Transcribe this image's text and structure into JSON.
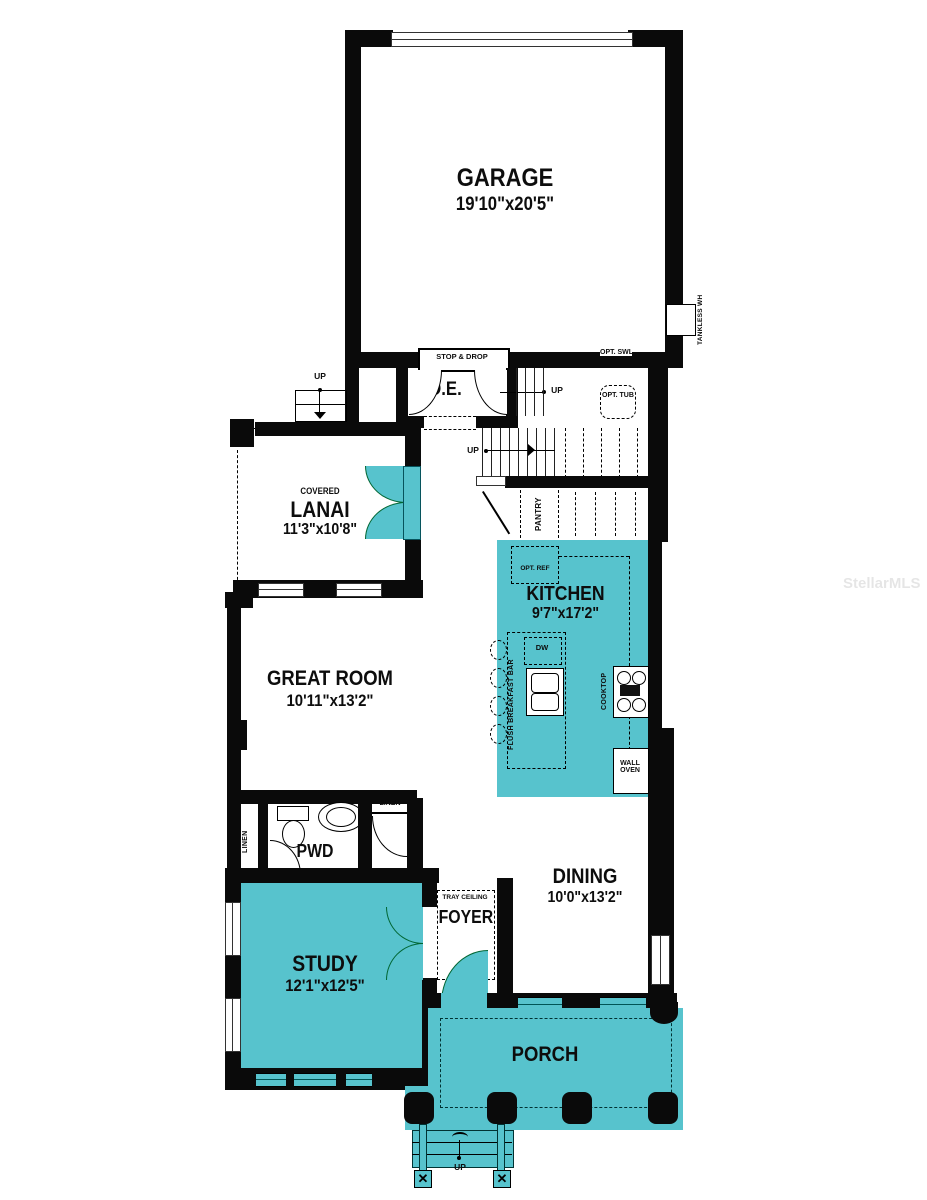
{
  "watermark": "StellarMLS",
  "colors": {
    "accent_teal": "#57c3cd",
    "wall": "#0a0a0a"
  },
  "rooms": {
    "garage": {
      "name": "GARAGE",
      "dims": "19'10\"x20'5\""
    },
    "oe": {
      "name": "O.E."
    },
    "lanai": {
      "prefix": "COVERED",
      "name": "LANAI",
      "dims": "11'3\"x10'8\""
    },
    "great_room": {
      "name": "GREAT ROOM",
      "dims": "10'11\"x13'2\""
    },
    "kitchen": {
      "name": "KITCHEN",
      "dims": "9'7\"x17'2\""
    },
    "pwd": {
      "name": "PWD"
    },
    "dining": {
      "name": "DINING",
      "dims": "10'0\"x13'2\""
    },
    "study": {
      "name": "STUDY",
      "dims": "12'1\"x12'5\""
    },
    "foyer": {
      "name": "FOYER"
    },
    "porch": {
      "name": "PORCH"
    }
  },
  "features": {
    "stop_drop": "STOP & DROP",
    "opt_swl": "OPT. SWL",
    "opt_tub": "OPT. TUB",
    "tankless_wh": "TANKLESS WH",
    "pantry": "PANTRY",
    "opt_ref": "OPT. REF",
    "dw": "DW",
    "flush_breakfast_bar": "FLUSH BREAKFAST BAR",
    "cooktop": "COOKTOP",
    "wall_oven": "WALL OVEN",
    "linen": "LINEN",
    "tray_ceiling": "TRAY CEILING",
    "up": "UP"
  }
}
